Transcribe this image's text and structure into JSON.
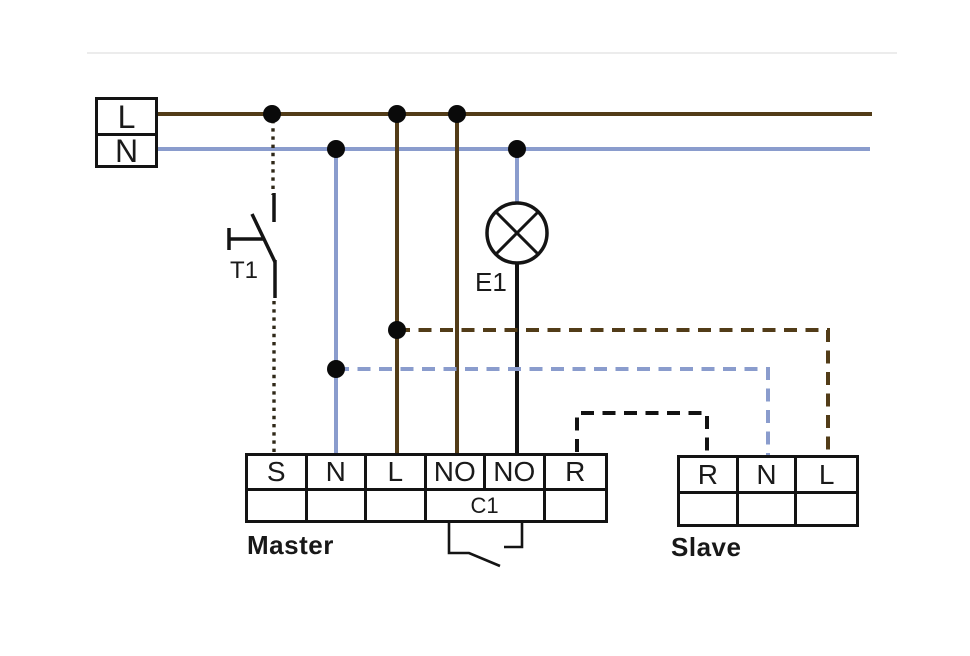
{
  "diagram": {
    "source": {
      "line_label": "L",
      "neutral_label": "N"
    },
    "push_button": {
      "label": "T1"
    },
    "lamp": {
      "label": "E1"
    },
    "master": {
      "label": "Master",
      "terminals": [
        "S",
        "N",
        "L",
        "NO",
        "NO",
        "R"
      ],
      "relay_label": "C1"
    },
    "slave": {
      "label": "Slave",
      "terminals": [
        "R",
        "N",
        "L"
      ]
    }
  },
  "icons": {
    "lamp": "circle-with-cross-lamp",
    "push_button": "normally-open-push-button",
    "relay_contact": "normally-open-contact",
    "junction": "filled-black-dot"
  },
  "colors": {
    "wire-brown": "#523c18",
    "wire-blue": "#8a9ccd",
    "wire-black": "#121212",
    "junction-dot": "#0a0a0a"
  }
}
